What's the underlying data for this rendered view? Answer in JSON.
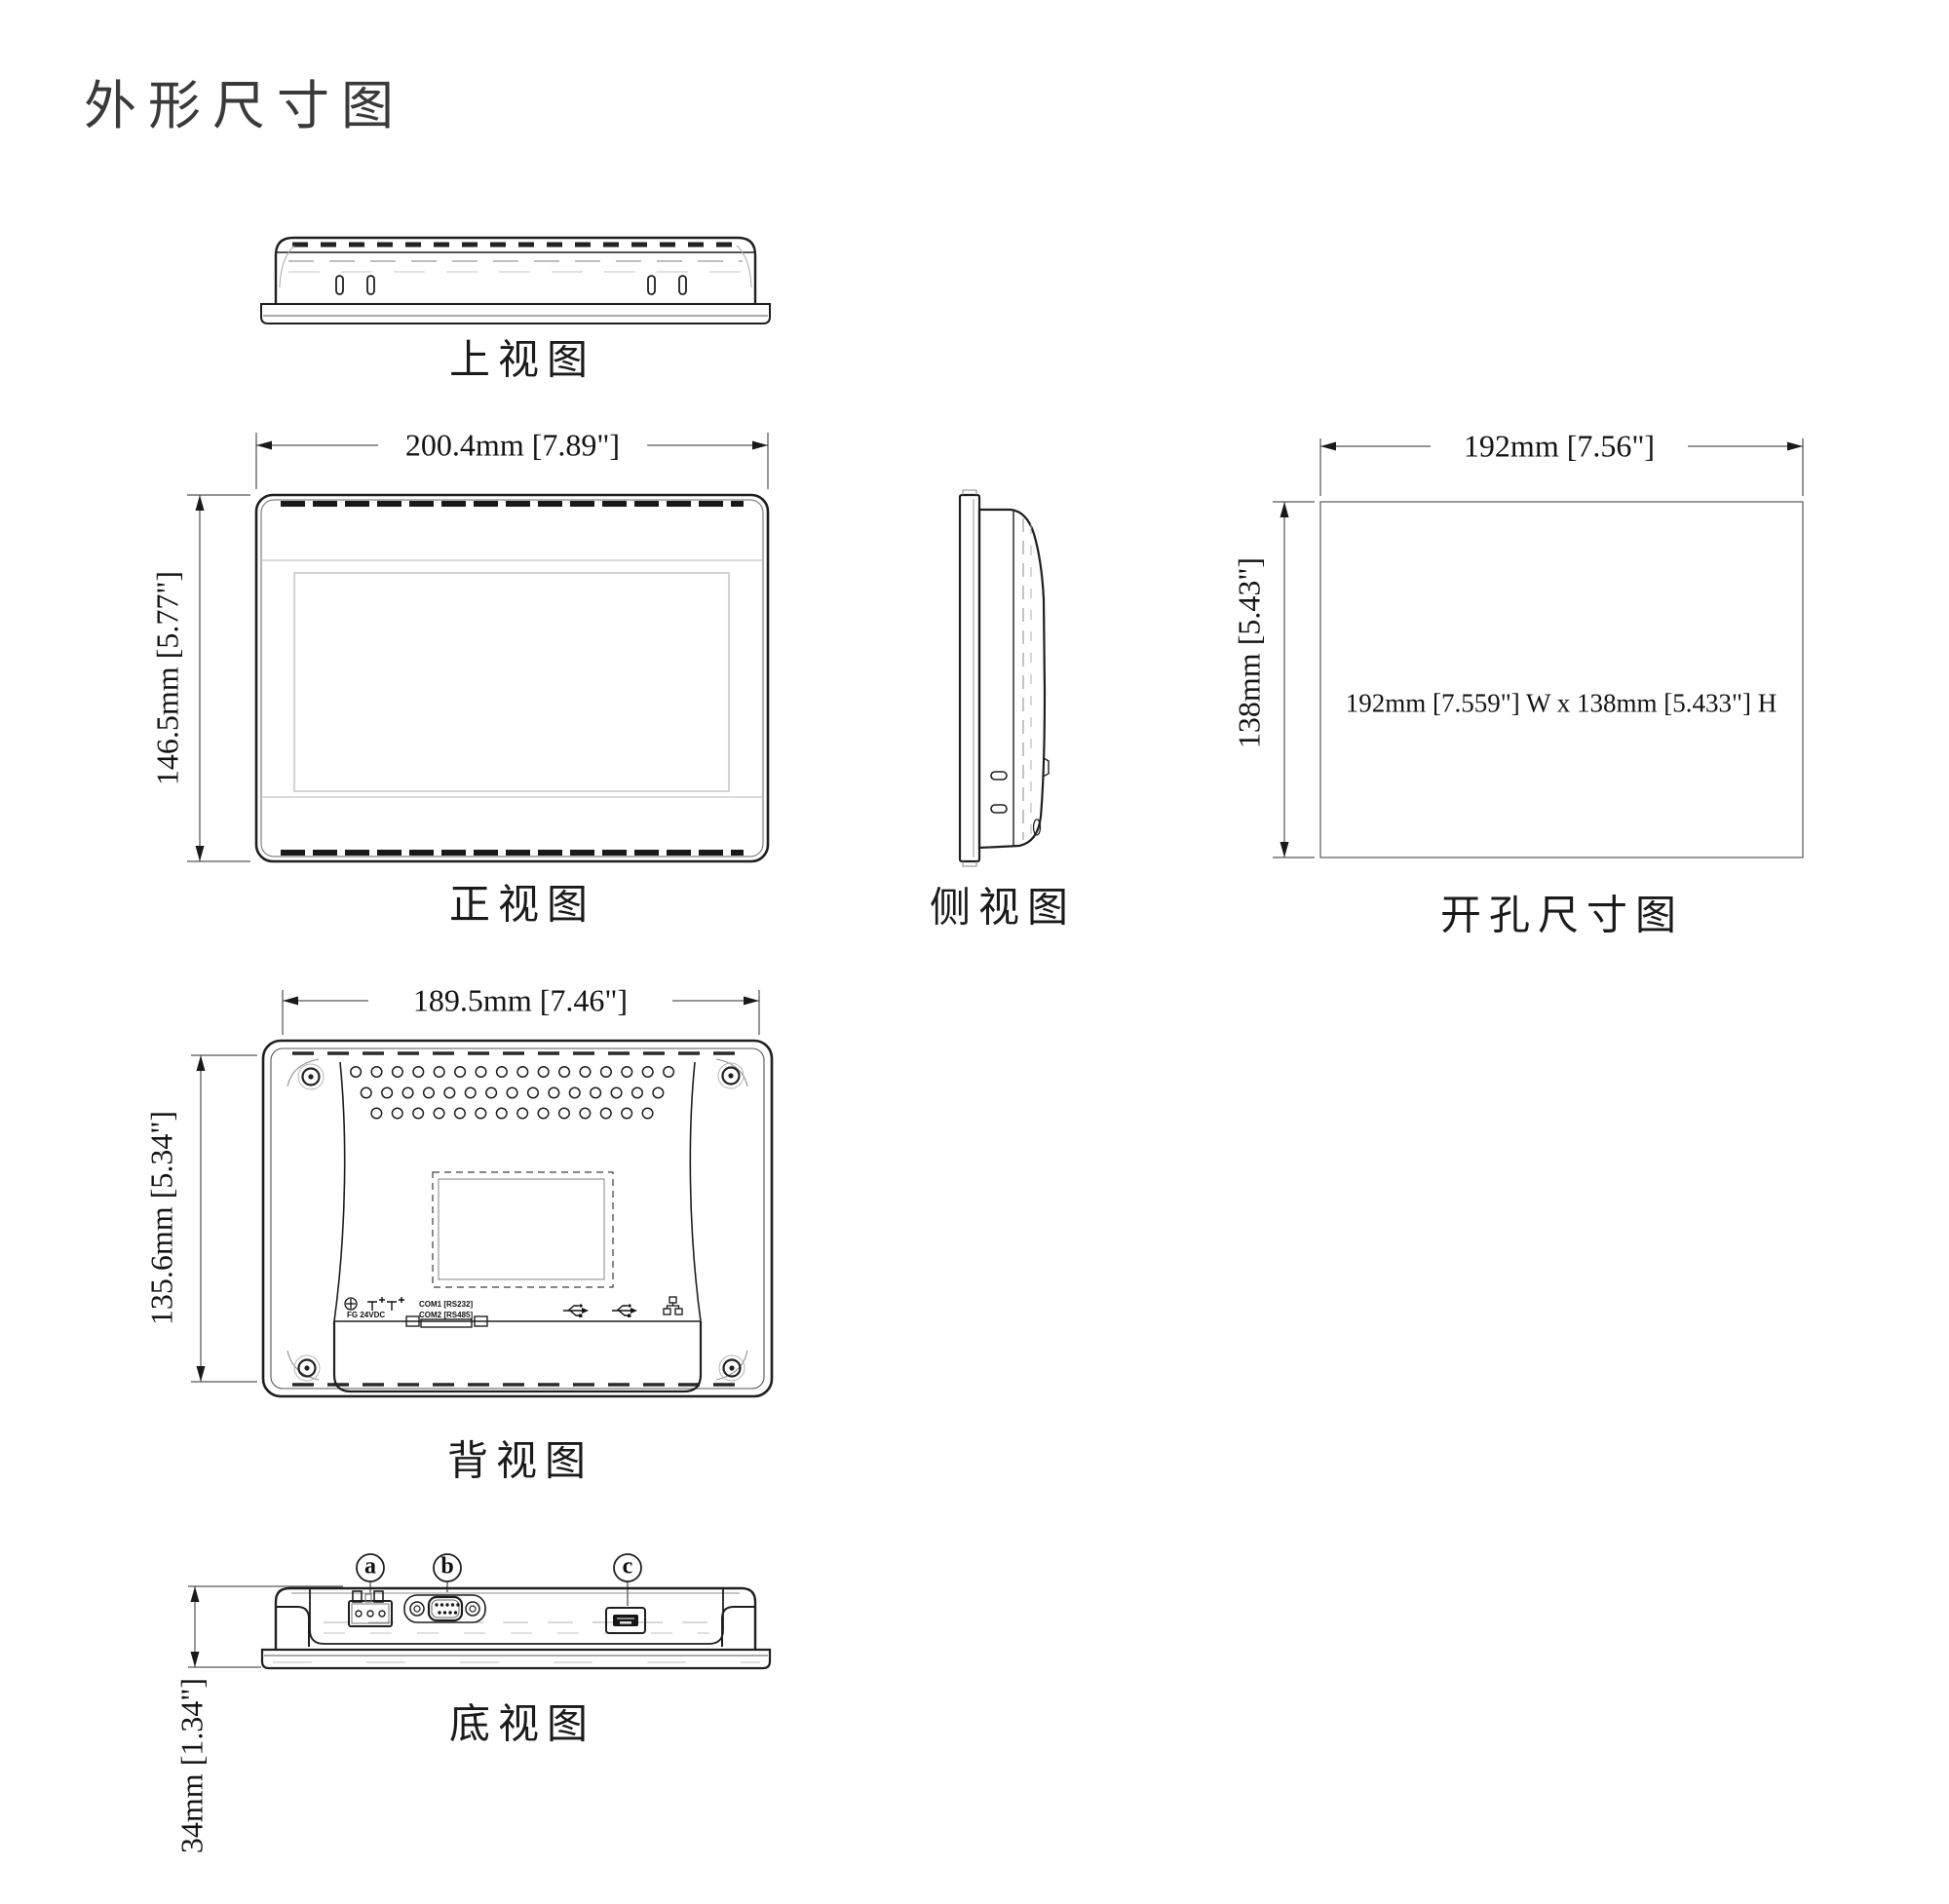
{
  "title": "外形尺寸图",
  "colors": {
    "line": "#1f1f1f",
    "dim_line": "#2e2e2e",
    "light_line": "#b5b5b5",
    "title": "#3a3a3a"
  },
  "views": {
    "top": {
      "label": "上视图"
    },
    "front": {
      "label": "正视图",
      "width_dim": "200.4mm [7.89\"]",
      "height_dim": "146.5mm [5.77\"]"
    },
    "side": {
      "label": "侧视图"
    },
    "cutout": {
      "label": "开孔尺寸图",
      "width_dim": "192mm [7.56\"]",
      "height_dim": "138mm [5.43\"]",
      "note": "192mm [7.559\"] W x 138mm [5.433\"] H"
    },
    "back": {
      "label": "背视图",
      "width_dim": "189.5mm [7.46\"]",
      "height_dim": "135.6mm [5.34\"]",
      "markings": {
        "fg": "FG  24VDC",
        "com1": "COM1 [RS232]",
        "com2": "COM2 [RS485]"
      }
    },
    "bottom": {
      "label": "底视图",
      "height_dim": "34mm [1.34\"]",
      "callouts": {
        "a": "a",
        "b": "b",
        "c": "c"
      }
    }
  }
}
